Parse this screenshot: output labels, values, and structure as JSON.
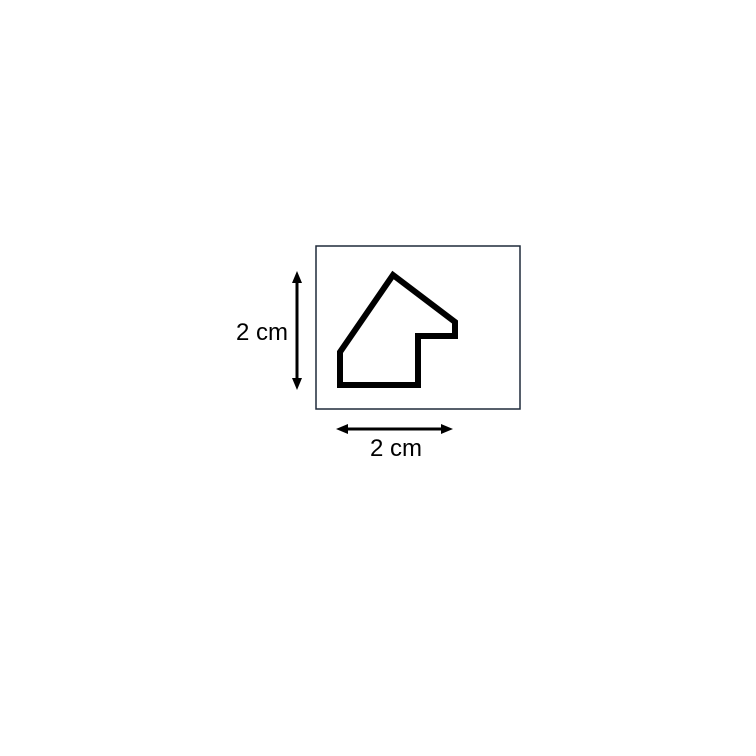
{
  "page": {
    "background_color": "#ffffff"
  },
  "diagram": {
    "frame": {
      "stroke_color": "#1f2a3a"
    },
    "shape": {
      "name": "irregular-polygon",
      "stroke_color": "#000000"
    },
    "arrows": {
      "color": "#000000"
    },
    "dimensions": {
      "height": {
        "label": "2 cm"
      },
      "width": {
        "label": "2 cm"
      }
    },
    "text_color": "#000000"
  }
}
